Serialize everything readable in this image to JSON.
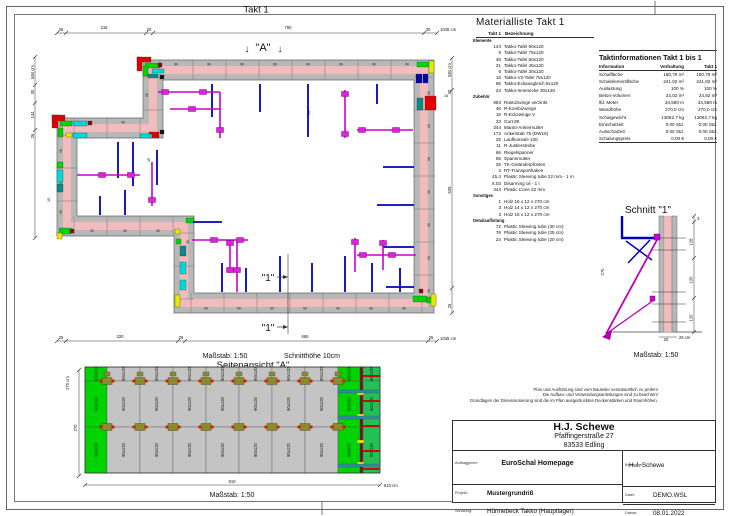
{
  "sheet": {
    "title": "Takt 1",
    "plan_caption_scale": "Maßstab: 1:50",
    "plan_caption_cut": "Schnitthöhe 10cm",
    "elevation_title": "Seitenansicht \"A\"",
    "elevation_caption": "Maßstab: 1:50",
    "section_title": "Schnitt \"1\"",
    "section_caption": "Maßstab: 1:50",
    "marker_a": "\"A\"",
    "marker_1": "\"1\"",
    "disclaimer": [
      "Plan und Ausführung sind vom Bauleiter verantwortlich zu prüfen!",
      "Die Aufbau- und Verwendungsanleitungen sind zu beachten!",
      "Grundlagen der Dimensionierung sind die im Plan ausgedruckten Deckenstärken und Raumhöhen."
    ]
  },
  "icons": {
    "arrow_down": "↓"
  },
  "plan": {
    "dims": {
      "top": [
        "25",
        "216",
        "20",
        "760",
        "30"
      ],
      "top_total": "1045 cm",
      "bottom": [
        "25",
        "320",
        "25",
        "665",
        "25"
      ],
      "bottom_total": "1045 cm",
      "left": [
        "684 cm",
        "30",
        "134",
        "26"
      ],
      "right": [
        "684 cm",
        "30",
        "629",
        "25"
      ],
      "wall_16": "16",
      "wall_15": "15",
      "wall_14": "14"
    },
    "panel_labels": {
      "p90": "90",
      "p60": "60",
      "p45": "45",
      "p30": "30"
    }
  },
  "elevation": {
    "panel_90": "90x120",
    "panel_60": "60x120",
    "dim_height": "270",
    "dim_height_total": "270 cm",
    "dim_width": "810",
    "dim_width_total": "810 cm"
  },
  "section": {
    "dims_right": [
      "3",
      "128",
      "120",
      "120"
    ],
    "dim_left": "270",
    "dim_thickness": "20",
    "dim_total": "25 cm"
  },
  "material_list": {
    "title": "Materialliste  Takt 1",
    "col_qty": "Takt 1",
    "col_name": "Bezeichnung",
    "sections": [
      {
        "label": "Elemente",
        "items": [
          [
            "144",
            "Takko-Tafel 90x120"
          ],
          [
            "6",
            "Takko-Tafel 75x120"
          ],
          [
            "48",
            "Takko-Tafel 60x120"
          ],
          [
            "21",
            "Takko-Tafel 45x120"
          ],
          [
            "6",
            "Takko-Tafel 30x120"
          ],
          [
            "16",
            "Takko-V2-Tafel 75x120"
          ],
          [
            "96",
            "Takko-Eckausgleich 5x120"
          ],
          [
            "24",
            "Takko-Innenecke 30x120"
          ]
        ]
      },
      {
        "label": "Zubehör",
        "items": [
          [
            "883",
            "Rastozwinge verzinkt"
          ],
          [
            "46",
            "R-Kombizwinge"
          ],
          [
            "18",
            "R-Eckzwinge V"
          ],
          [
            "33",
            "Gurt 80"
          ],
          [
            "344",
            "Manto-Ankermutter"
          ],
          [
            "172",
            "Ankerstab 75 (DW15)"
          ],
          [
            "25",
            "Laufkonsole 100"
          ],
          [
            "11",
            "R-Justierstrebe"
          ],
          [
            "66",
            "Riegelspanner"
          ],
          [
            "66",
            "Spannmutter"
          ],
          [
            "25",
            "TK-Geländerpfosten"
          ],
          [
            "2",
            "RT-Transporthaken"
          ],
          [
            "45,4",
            "Plastic Sleeving tube 22 mm - 1 m"
          ],
          [
            "8,03",
            "Disarming oil - 1 l"
          ],
          [
            "344",
            "Plastic Cone 22 mm"
          ]
        ]
      },
      {
        "label": "Sonstiges",
        "items": [
          [
            "1",
            "Holz 16 x 12 x 270 cm"
          ],
          [
            "3",
            "Holz 14 x 12 x 270 cm"
          ],
          [
            "3",
            "Holz 15 x 12 x 270 cm"
          ]
        ]
      },
      {
        "label": "Detailauflistung",
        "items": [
          [
            "72",
            "Plastic Sleeving tube (30 cm)"
          ],
          [
            "76",
            "Plastic Sleeving tube (25 cm)"
          ],
          [
            "24",
            "Plastic Sleeving tube (20 cm)"
          ]
        ]
      }
    ]
  },
  "takt_info": {
    "title": "Taktinformationen  Takt 1 bis 1",
    "col_info": "Information",
    "col_vorhaltung": "Vorhaltung",
    "col_takt": "Takt 1",
    "rows": [
      [
        "Schalfläche",
        "180,79 m²",
        "180,79 m²"
      ],
      [
        "Schalelementfläche",
        "241,02 m²",
        "241,82 m²"
      ],
      [
        "Auslastung",
        "100 %",
        "100 %"
      ],
      [
        "Beton-Volumen",
        "24,02 m³",
        "24,82 m³"
      ],
      [
        "lfd. Meter",
        "34,580 m",
        "34,580 m"
      ],
      [
        "Wandhöhe",
        "270,0 cm",
        "270,0 cm"
      ],
      [
        "Schalgewicht",
        "13062,7 kg",
        "13062,7 kg"
      ],
      [
        "Einschalzeit",
        "0:00 Std.",
        "0:00 Std."
      ],
      [
        "Ausschalzeit",
        "0:00 Std.",
        "0:00 Std."
      ],
      [
        "Schalungspreis",
        "0,00 €",
        "0,00 €"
      ]
    ]
  },
  "title_block": {
    "company": "H.J. Schewe",
    "address1": "Pfaffingerstraße 27",
    "address2": "83533 Edling",
    "auftraggeber_label": "Auftraggeber:",
    "auftraggeber": "EuroSchal Homepage",
    "bearbeiter_label": "Bearbeiter:",
    "bearbeiter": "H.J. Schewe",
    "projekt_label": "Projekt:",
    "projekt": "Mustergrundriß",
    "datei_label": "Datei:",
    "datei": "DEMO.WSL",
    "schalung_label": "Schalung:",
    "schalung": "Hünnebeck Takko (Hauptlager)",
    "datum_label": "Datum:",
    "datum": "08.01.2022"
  },
  "colors": {
    "wall_concrete": "#f2bcbc",
    "panel_rail": "#b8b8b8",
    "panel_green": "#00d400",
    "panel_cyan": "#00d8d8",
    "panel_teal": "#0a8a8a",
    "panel_red": "#e10000",
    "panel_yellow": "#e8e800",
    "prop_blue": "#0000bb",
    "brace_magenta": "#cc00cc",
    "clamp_khaki": "#8a8a30",
    "mark_red": "#cc2200",
    "maroon": "#7a0f0f"
  }
}
